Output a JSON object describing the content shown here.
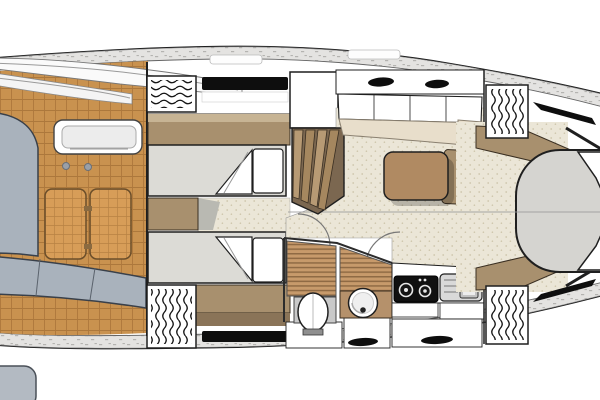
{
  "plan": {
    "type": "motor-yacht-interior-deck-plan",
    "orientation": "bow-right",
    "rooms": [
      {
        "id": "aft-cockpit",
        "features": [
          "c-shaped-sofa",
          "folding-teak-table",
          "wet-bar-sink",
          "cup-holders",
          "teak-deck"
        ]
      },
      {
        "id": "mid-guest-cabin",
        "features": [
          "twin-berth-upper",
          "twin-berth-lower",
          "pillows",
          "turned-down-blankets",
          "headboard-cabinet",
          "hull-window",
          "louvre-hatch-upper",
          "louvre-hatch-lower",
          "wardrobe"
        ]
      },
      {
        "id": "salon",
        "features": [
          "companionway-stairs",
          "u-shaped-dinette",
          "backrest-panels",
          "overhead-lockers",
          "dinette-table",
          "door-swings",
          "carpet"
        ]
      },
      {
        "id": "head",
        "features": [
          "toilet",
          "round-basin",
          "teak-grate-floor",
          "vanity-counter",
          "drawers"
        ]
      },
      {
        "id": "galley",
        "features": [
          "two-burner-cooktop",
          "stainless-sink-with-drainboard",
          "drawers",
          "oval-handles"
        ]
      },
      {
        "id": "bow-cabin",
        "features": [
          "island-berth",
          "bow-pillows",
          "flanking-cabinets",
          "louvre-hatch-upper",
          "louvre-hatch-lower",
          "hull-window-slashes",
          "carpet"
        ]
      }
    ],
    "counts": {
      "cooktop_burners": 2,
      "twin_berths": 2,
      "louvre_hatches": 4,
      "overhead_locker_vents": 2,
      "drawer_handles": 3
    }
  },
  "colors": {
    "outline": "#1f1f1f",
    "wall": "#55504a",
    "hull_white": "#ffffff",
    "deck_band": "#e4e3e1",
    "deck_dot": "#b4b3b0",
    "teak": "#c9924f",
    "teak_line": "#a26e35",
    "table_wood": "#d79d58",
    "sofa": "#a9b2bc",
    "sofa_dark": "#39404a",
    "sofa_shadow": "#23272d",
    "carpet": "#ebe6d7",
    "carpet_dot": "#cfc6ac",
    "beige_seat": "#e8decb",
    "cabinet_brown": "#a8906e",
    "cabinet_brown_dark": "#8a7458",
    "cabinet_highlight": "#c7b494",
    "counter_brown": "#b5916b",
    "dinette_table": "#b08a62",
    "bed": "#dcdbd6",
    "bow_bed": "#d5d4d0",
    "slat": "#c79a6b",
    "slat_line": "#8f6a44",
    "window": "#0e0e0e",
    "hatch_wave": "#141414",
    "steel": "#d9d9d9",
    "cooktop": "#101010",
    "white": "#ffffff"
  }
}
